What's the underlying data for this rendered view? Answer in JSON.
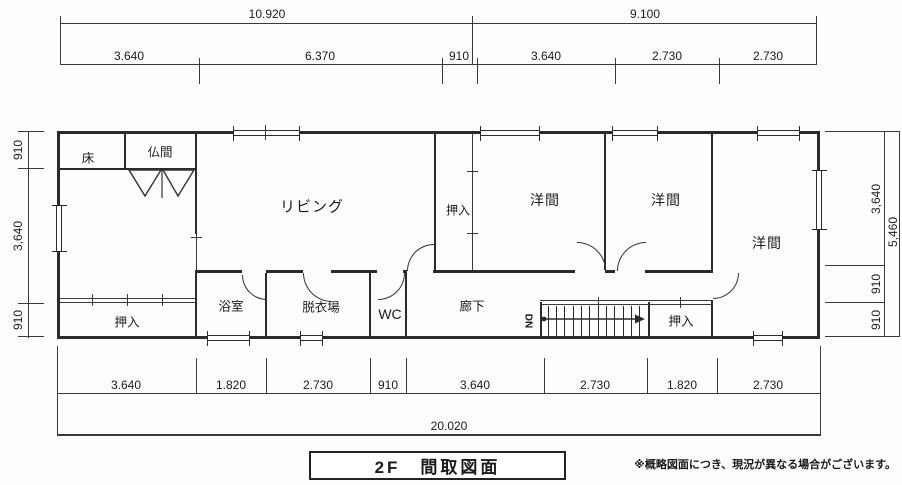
{
  "title": "2F　間取図面",
  "disclaimer": "※概略図面につき、現況が異なる場合がございます。",
  "rooms": {
    "toko": "床",
    "butsuma": "仏間",
    "living": "リビング",
    "oshiire_center": "押入",
    "youma_1": "洋間",
    "youma_2": "洋間",
    "youma_3": "洋間",
    "oshiire_left": "押入",
    "bathroom": "浴室",
    "dressing": "脱衣場",
    "wc": "WC",
    "hallway": "廊下",
    "oshiire_right": "押入",
    "stairs_down": "DN"
  },
  "dimensions": {
    "top_total": [
      "10.920",
      "9.100"
    ],
    "top_segments": [
      "3.640",
      "6.370",
      "910",
      "3.640",
      "2.730",
      "2.730"
    ],
    "left_segments": [
      "910",
      "3,640",
      "910"
    ],
    "right_segments": [
      "3,640",
      "910",
      "910"
    ],
    "right_total": "5,460",
    "bottom_segments": [
      "3.640",
      "1.820",
      "2.730",
      "910",
      "3.640",
      "2.730",
      "1.820",
      "2.730"
    ],
    "bottom_total": "20.020"
  }
}
